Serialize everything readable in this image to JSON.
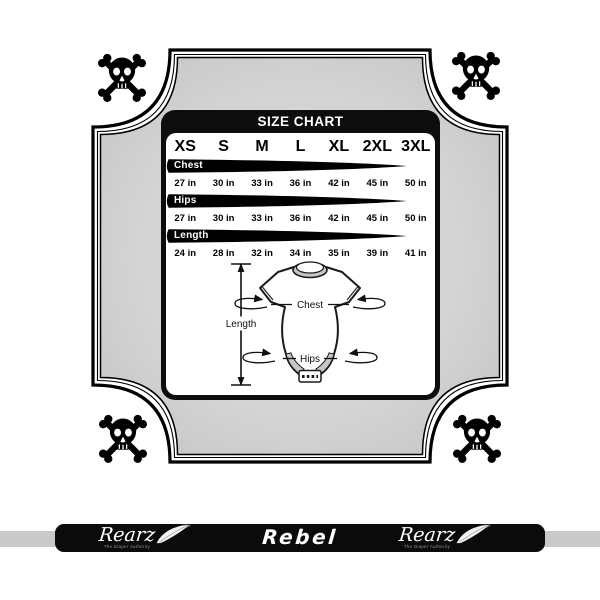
{
  "chart_data": {
    "type": "table",
    "title": "SIZE CHART",
    "categories": [
      "XS",
      "S",
      "M",
      "L",
      "XL",
      "2XL",
      "3XL"
    ],
    "series": [
      {
        "name": "Chest",
        "values": [
          "27 in",
          "30 in",
          "33 in",
          "36 in",
          "42 in",
          "45 in",
          "50 in"
        ]
      },
      {
        "name": "Hips",
        "values": [
          "27 in",
          "30 in",
          "33 in",
          "36 in",
          "42 in",
          "45 in",
          "50 in"
        ]
      },
      {
        "name": "Length",
        "values": [
          "24 in",
          "28 in",
          "32 in",
          "34 in",
          "35 in",
          "39 in",
          "41 in"
        ]
      }
    ]
  },
  "diagram": {
    "length_label": "Length",
    "chest_label": "Chest",
    "hips_label": "Hips"
  },
  "footer": {
    "brand": "Rearz",
    "brand_tagline": "The Diaper Authority",
    "product_name": "Rebel"
  },
  "icons": {
    "corners": "skull-crossbones-icon",
    "brand": "feather-icon"
  },
  "colors": {
    "frame_fill_center": "#e0e0e0",
    "frame_fill_edge": "#c2c2c2",
    "card_black": "#0d0d0d",
    "banner_black": "#000000",
    "footer_bar": "#0b0b0b",
    "footer_strip": "#c9c9c9"
  }
}
